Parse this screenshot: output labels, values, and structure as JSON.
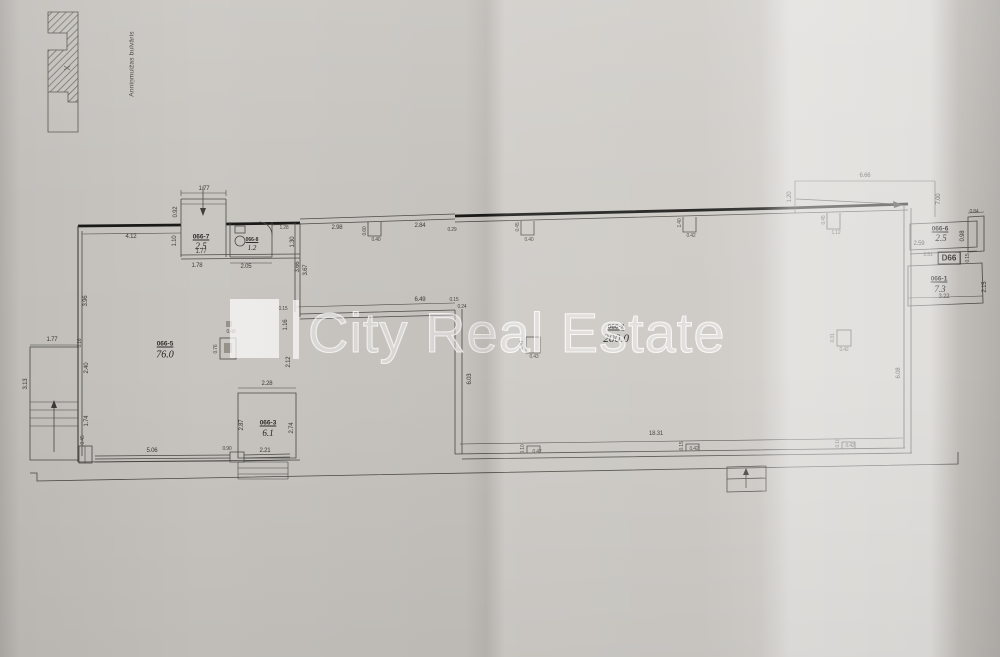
{
  "street_label": "Anniņmuižas bulvāris",
  "watermark": "City Real Estate",
  "door_label": "D66",
  "rooms": [
    {
      "id": "066-7",
      "area": "2.5"
    },
    {
      "id": "066-8",
      "area": "1.2"
    },
    {
      "id": "066-5",
      "area": "76.0"
    },
    {
      "id": "066-3",
      "area": "6.1"
    },
    {
      "id": "066-2",
      "area": "200.0"
    },
    {
      "id": "066-6",
      "area": "2.5"
    },
    {
      "id": "066-1",
      "area": "7.3"
    }
  ],
  "dims": [
    "1.77",
    "0.92",
    "4.12",
    "1.10",
    "1.77",
    "1.78",
    "2.05",
    "1.28",
    "1.30",
    "3.66",
    "3.67",
    "3.96",
    "0.16",
    "2.40",
    "1.74",
    "0.45",
    "1.77",
    "3.13",
    "0.76",
    "0.48",
    "5.06",
    "0.90",
    "2.21",
    "2.28",
    "2.87",
    "2.74",
    "2.98",
    "0.60",
    "0.40",
    "2.84",
    "0.29",
    "0.45",
    "0.40",
    "1.40",
    "0.42",
    "0.45",
    "1.12",
    "6.66",
    "1.20",
    "7.00",
    "0.84",
    "6.49",
    "0.15",
    "1.16",
    "0.15",
    "0.24",
    "6.03",
    "6.08",
    "0.41",
    "0.43",
    "0.31",
    "0.42",
    "18.31",
    "0.10",
    "0.42",
    "0.15",
    "0.42",
    "0.10",
    "0.42",
    "2.59",
    "0.98",
    "2.51",
    "0.15",
    "2.15",
    "3.22",
    "2.12"
  ]
}
